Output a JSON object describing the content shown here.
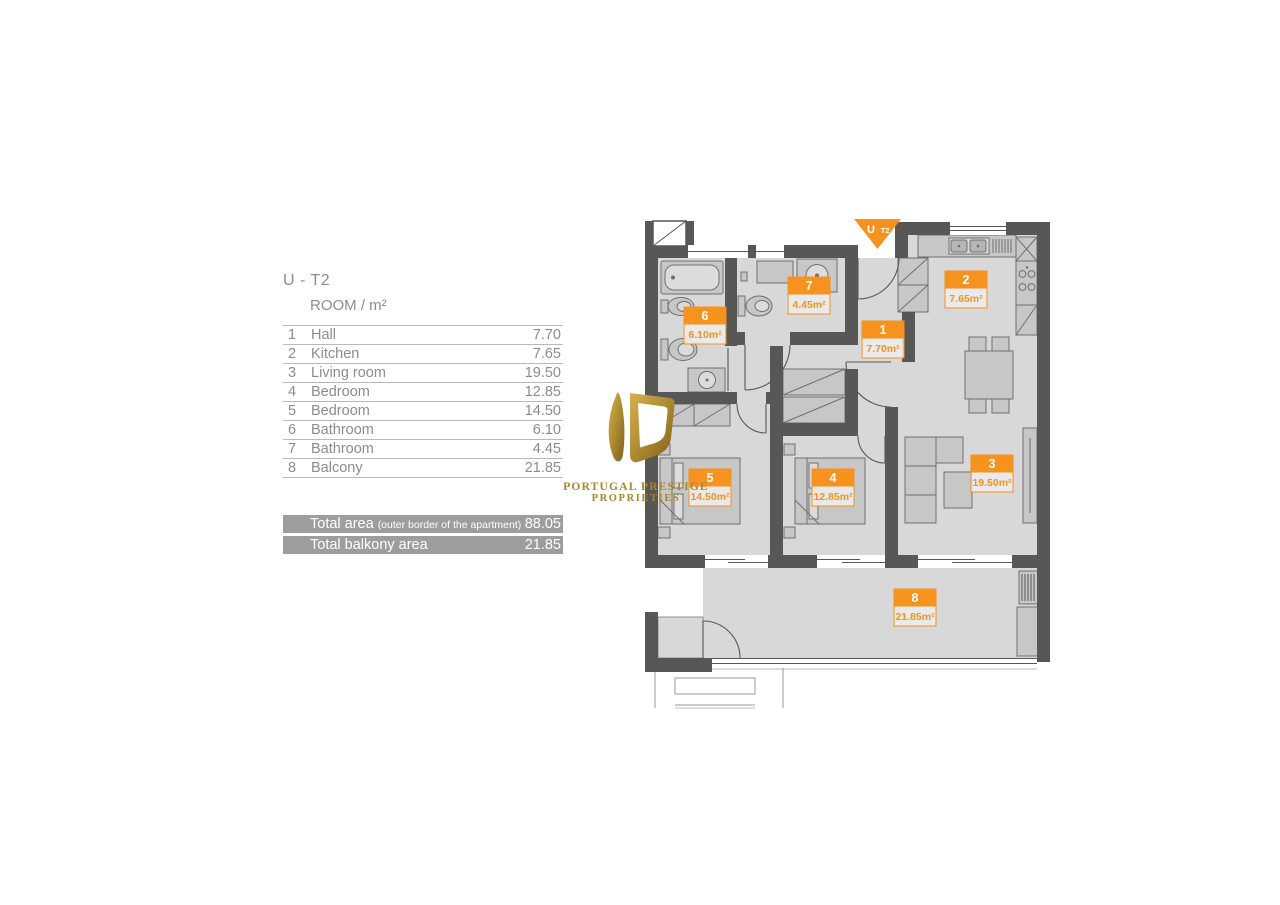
{
  "title": "U - T2",
  "table": {
    "header": "ROOM / m²",
    "rows": [
      {
        "num": "1",
        "name": "Hall",
        "area": "7.70"
      },
      {
        "num": "2",
        "name": "Kitchen",
        "area": "7.65"
      },
      {
        "num": "3",
        "name": "Living room",
        "area": "19.50"
      },
      {
        "num": "4",
        "name": "Bedroom",
        "area": "12.85"
      },
      {
        "num": "5",
        "name": "Bedroom",
        "area": "14.50"
      },
      {
        "num": "6",
        "name": "Bathroom",
        "area": "6.10"
      },
      {
        "num": "7",
        "name": "Bathroom",
        "area": "4.45"
      },
      {
        "num": "8",
        "name": "Balcony",
        "area": "21.85"
      }
    ],
    "totals": [
      {
        "label": "Total area",
        "note": "(outer border of the apartment)",
        "value": "88.05"
      },
      {
        "label": "Total balkony area",
        "note": "",
        "value": "21.85"
      }
    ]
  },
  "logo": {
    "line1": "PORTUGAL PRESTIGE",
    "line2": "PROPRIETIES",
    "gold": "#a8862e"
  },
  "plan": {
    "entrance_marker": {
      "unit": "U",
      "type": "T2"
    },
    "rooms": [
      {
        "number": "1",
        "area": "7.70m²"
      },
      {
        "number": "2",
        "area": "7.65m²"
      },
      {
        "number": "3",
        "area": "19.50m²"
      },
      {
        "number": "4",
        "area": "12.85m²"
      },
      {
        "number": "5",
        "area": "14.50m²"
      },
      {
        "number": "6",
        "area": "6.10m²"
      },
      {
        "number": "7",
        "area": "4.45m²"
      },
      {
        "number": "8",
        "area": "21.85m²"
      }
    ],
    "colors": {
      "accent": "#F6921E",
      "wall": "#575756",
      "floor": "#D8D8D8"
    }
  }
}
